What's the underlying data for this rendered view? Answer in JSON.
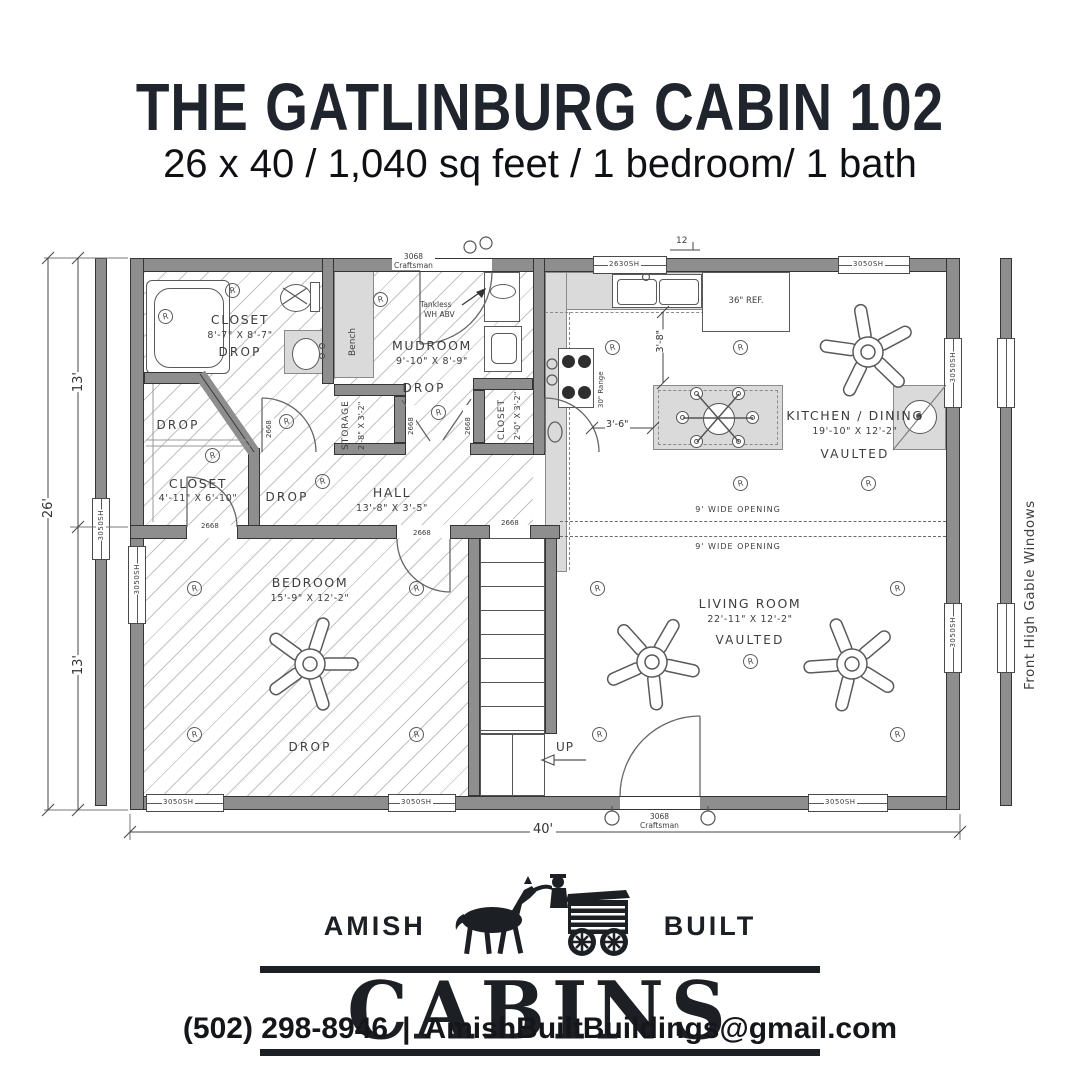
{
  "colors": {
    "wall": "#8e8e8e",
    "shade": "#dadada",
    "line": "#555555",
    "ink": "#20242c"
  },
  "header": {
    "title": "THE GATLINBURG CABIN 102",
    "subtitle": "26 x 40 / 1,040 sq feet / 1 bedroom/ 1 bath"
  },
  "plan": {
    "rooms": {
      "bath_closet": {
        "name": "CLOSET",
        "dims": "8'-7\" X 8'-7\"",
        "ceiling": "DROP"
      },
      "mudroom": {
        "name": "MUDROOM",
        "dims": "9'-10\" X 8'-9\"",
        "ceiling": "DROP"
      },
      "storage": {
        "name": "STORAGE",
        "dims": "2'-8\" X 3'-2\""
      },
      "left_closet": {
        "name": "CLOSET",
        "dims": "4'-11\" X 6'-10\"",
        "ceiling": "DROP"
      },
      "hall": {
        "name": "HALL",
        "dims": "13'-8\" X 3'-5\"",
        "ceiling": "DROP"
      },
      "kitchen_closet": {
        "name": "CLOSET",
        "dims": "2'-0\" X 3'-2\""
      },
      "kitchen": {
        "name": "KITCHEN / DINING",
        "dims": "19'-10\" X 12'-2\"",
        "ceiling": "VAULTED"
      },
      "living": {
        "name": "LIVING ROOM",
        "dims": "22'-11\" X 12'-2\"",
        "ceiling": "VAULTED"
      },
      "bedroom": {
        "name": "BEDROOM",
        "dims": "15'-9\" X 12'-2\"",
        "ceiling": "DROP"
      }
    },
    "fixtures": {
      "bench": "Bench",
      "tankless_1": "Tankless",
      "tankless_2": "WH ABV",
      "range": "30\" Range",
      "fridge": "36\" REF.",
      "stairs_up": "UP"
    },
    "openings": {
      "door_small": "2668",
      "door_entry_size": "3068",
      "door_entry_style": "Craftsman",
      "window_kitchen": "2630SH",
      "window_std": "3050SH",
      "wide_opening": "9' WIDE OPENING"
    },
    "dimensions": {
      "width_total": "40'",
      "depth_total": "26'",
      "depth_half": "13'",
      "island_clearance": "3'-6\"",
      "counter_clearance": "3'-8\"",
      "roof_pitch": "12"
    },
    "symbols": {
      "recessed": "R"
    },
    "annotations": {
      "gable": "Front High Gable Windows"
    }
  },
  "logo": {
    "word_left": "AMISH",
    "word_right": "BUILT",
    "word_main": "CABINS"
  },
  "footer": {
    "phone": "(502) 298-8946",
    "separator": "|",
    "email": "AmishBuiltBuildings@gmail.com"
  }
}
